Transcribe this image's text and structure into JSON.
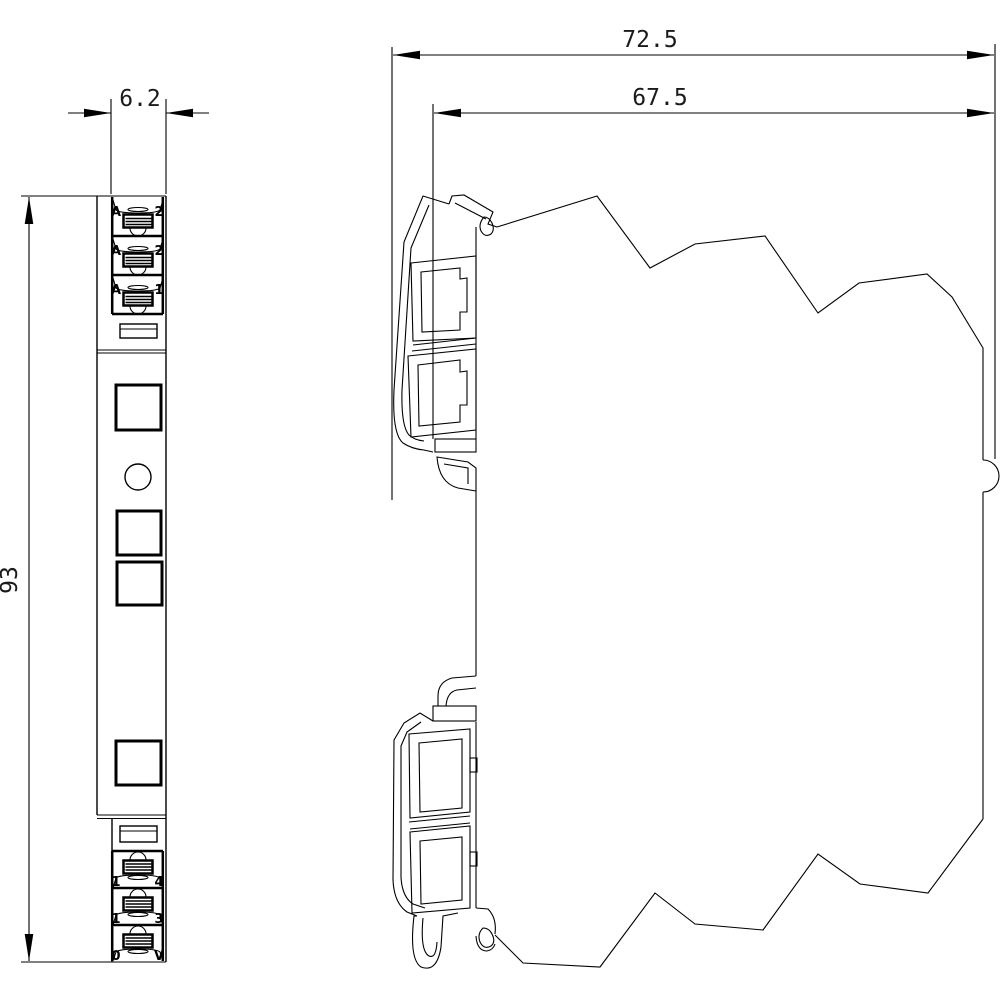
{
  "page": {
    "background": "#ffffff",
    "stroke_color": "#000000"
  },
  "drawing": {
    "type": "dimensional-outline-drawing",
    "views": {
      "left": "front-view",
      "right": "side-view"
    },
    "dimensions": {
      "front_width": "6.2",
      "total_depth": "72.5",
      "body_depth": "67.5",
      "height": "93"
    },
    "front_view": {
      "top_terminals": [
        {
          "left": "A",
          "right": "2"
        },
        {
          "left": "A",
          "right": "2"
        },
        {
          "left": "A",
          "right": "1"
        }
      ],
      "bottom_terminals": [
        {
          "left": "1",
          "right": "4"
        },
        {
          "left": "1",
          "right": "3"
        },
        {
          "left": "0",
          "right": "V"
        }
      ]
    }
  }
}
